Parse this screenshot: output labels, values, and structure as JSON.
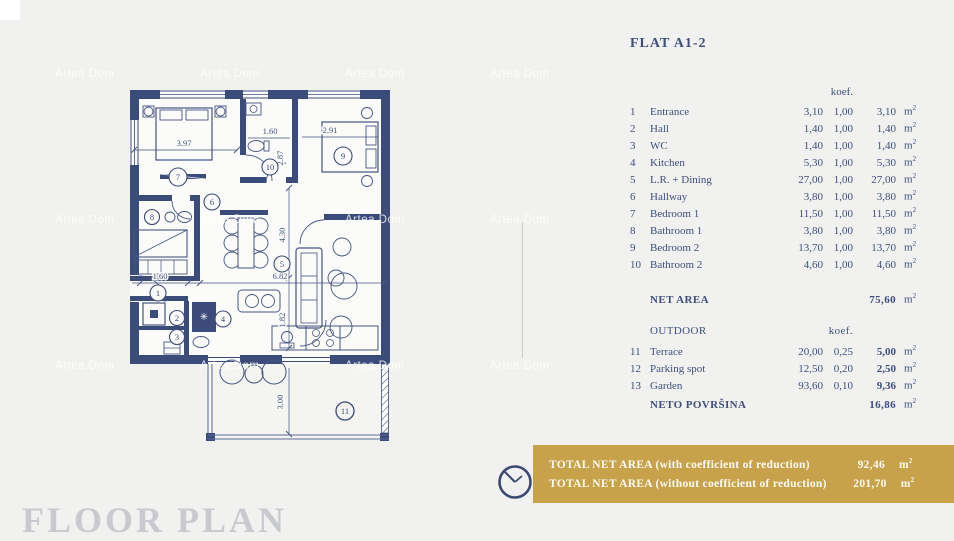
{
  "watermark": {
    "text": "Artea Dom"
  },
  "flat": {
    "title": "FLAT A1-2",
    "koef_header": "koef.",
    "unit_m": "m",
    "unit_exp": "2",
    "rooms": [
      {
        "num": "1",
        "name": "Entrance",
        "area": "3,10",
        "koef": "1,00",
        "result": "3,10"
      },
      {
        "num": "2",
        "name": "Hall",
        "area": "1,40",
        "koef": "1,00",
        "result": "1,40"
      },
      {
        "num": "3",
        "name": "WC",
        "area": "1,40",
        "koef": "1,00",
        "result": "1,40"
      },
      {
        "num": "4",
        "name": "Kitchen",
        "area": "5,30",
        "koef": "1,00",
        "result": "5,30"
      },
      {
        "num": "5",
        "name": "L.R. + Dining",
        "area": "27,00",
        "koef": "1,00",
        "result": "27,00"
      },
      {
        "num": "6",
        "name": "Hallway",
        "area": "3,80",
        "koef": "1,00",
        "result": "3,80"
      },
      {
        "num": "7",
        "name": "Bedroom 1",
        "area": "11,50",
        "koef": "1,00",
        "result": "11,50"
      },
      {
        "num": "8",
        "name": "Bathroom 1",
        "area": "3,80",
        "koef": "1,00",
        "result": "3,80"
      },
      {
        "num": "9",
        "name": "Bedroom 2",
        "area": "13,70",
        "koef": "1,00",
        "result": "13,70"
      },
      {
        "num": "10",
        "name": "Bathroom 2",
        "area": "4,60",
        "koef": "1,00",
        "result": "4,60"
      }
    ],
    "net_area": {
      "label": "NET AREA",
      "value": "75,60"
    },
    "outdoor": {
      "label": "OUTDOOR",
      "koef_header": "koef.",
      "rows": [
        {
          "num": "11",
          "name": "Terrace",
          "area": "20,00",
          "koef": "0,25",
          "result": "5,00"
        },
        {
          "num": "12",
          "name": "Parking spot",
          "area": "12,50",
          "koef": "0,20",
          "result": "2,50"
        },
        {
          "num": "13",
          "name": "Garden",
          "area": "93,60",
          "koef": "0,10",
          "result": "9,36"
        }
      ],
      "total": {
        "label": "NETO POVRŠINA",
        "value": "16,86"
      }
    }
  },
  "banner": {
    "line1": {
      "label": "TOTAL NET AREA (with coefficient of reduction)",
      "value": "92,46"
    },
    "line2": {
      "label": "TOTAL NET AREA (without coefficient of reduction)",
      "value": "201,70"
    }
  },
  "footer": {
    "cropped_title": "FLOOR PLAN"
  },
  "plan": {
    "room_numbers": [
      "1",
      "2",
      "3",
      "4",
      "5",
      "6",
      "7",
      "8",
      "9",
      "10",
      "11"
    ],
    "dims": {
      "bed1_w": "3.97",
      "bath2_w": "1.60",
      "bath2_h": "2.87",
      "bed2_w": "2.91",
      "living_h": "4.30",
      "living_w": "6.82",
      "entry_w": "1.60",
      "kitchen_h": "1.82",
      "terrace_h": "3.00"
    }
  }
}
